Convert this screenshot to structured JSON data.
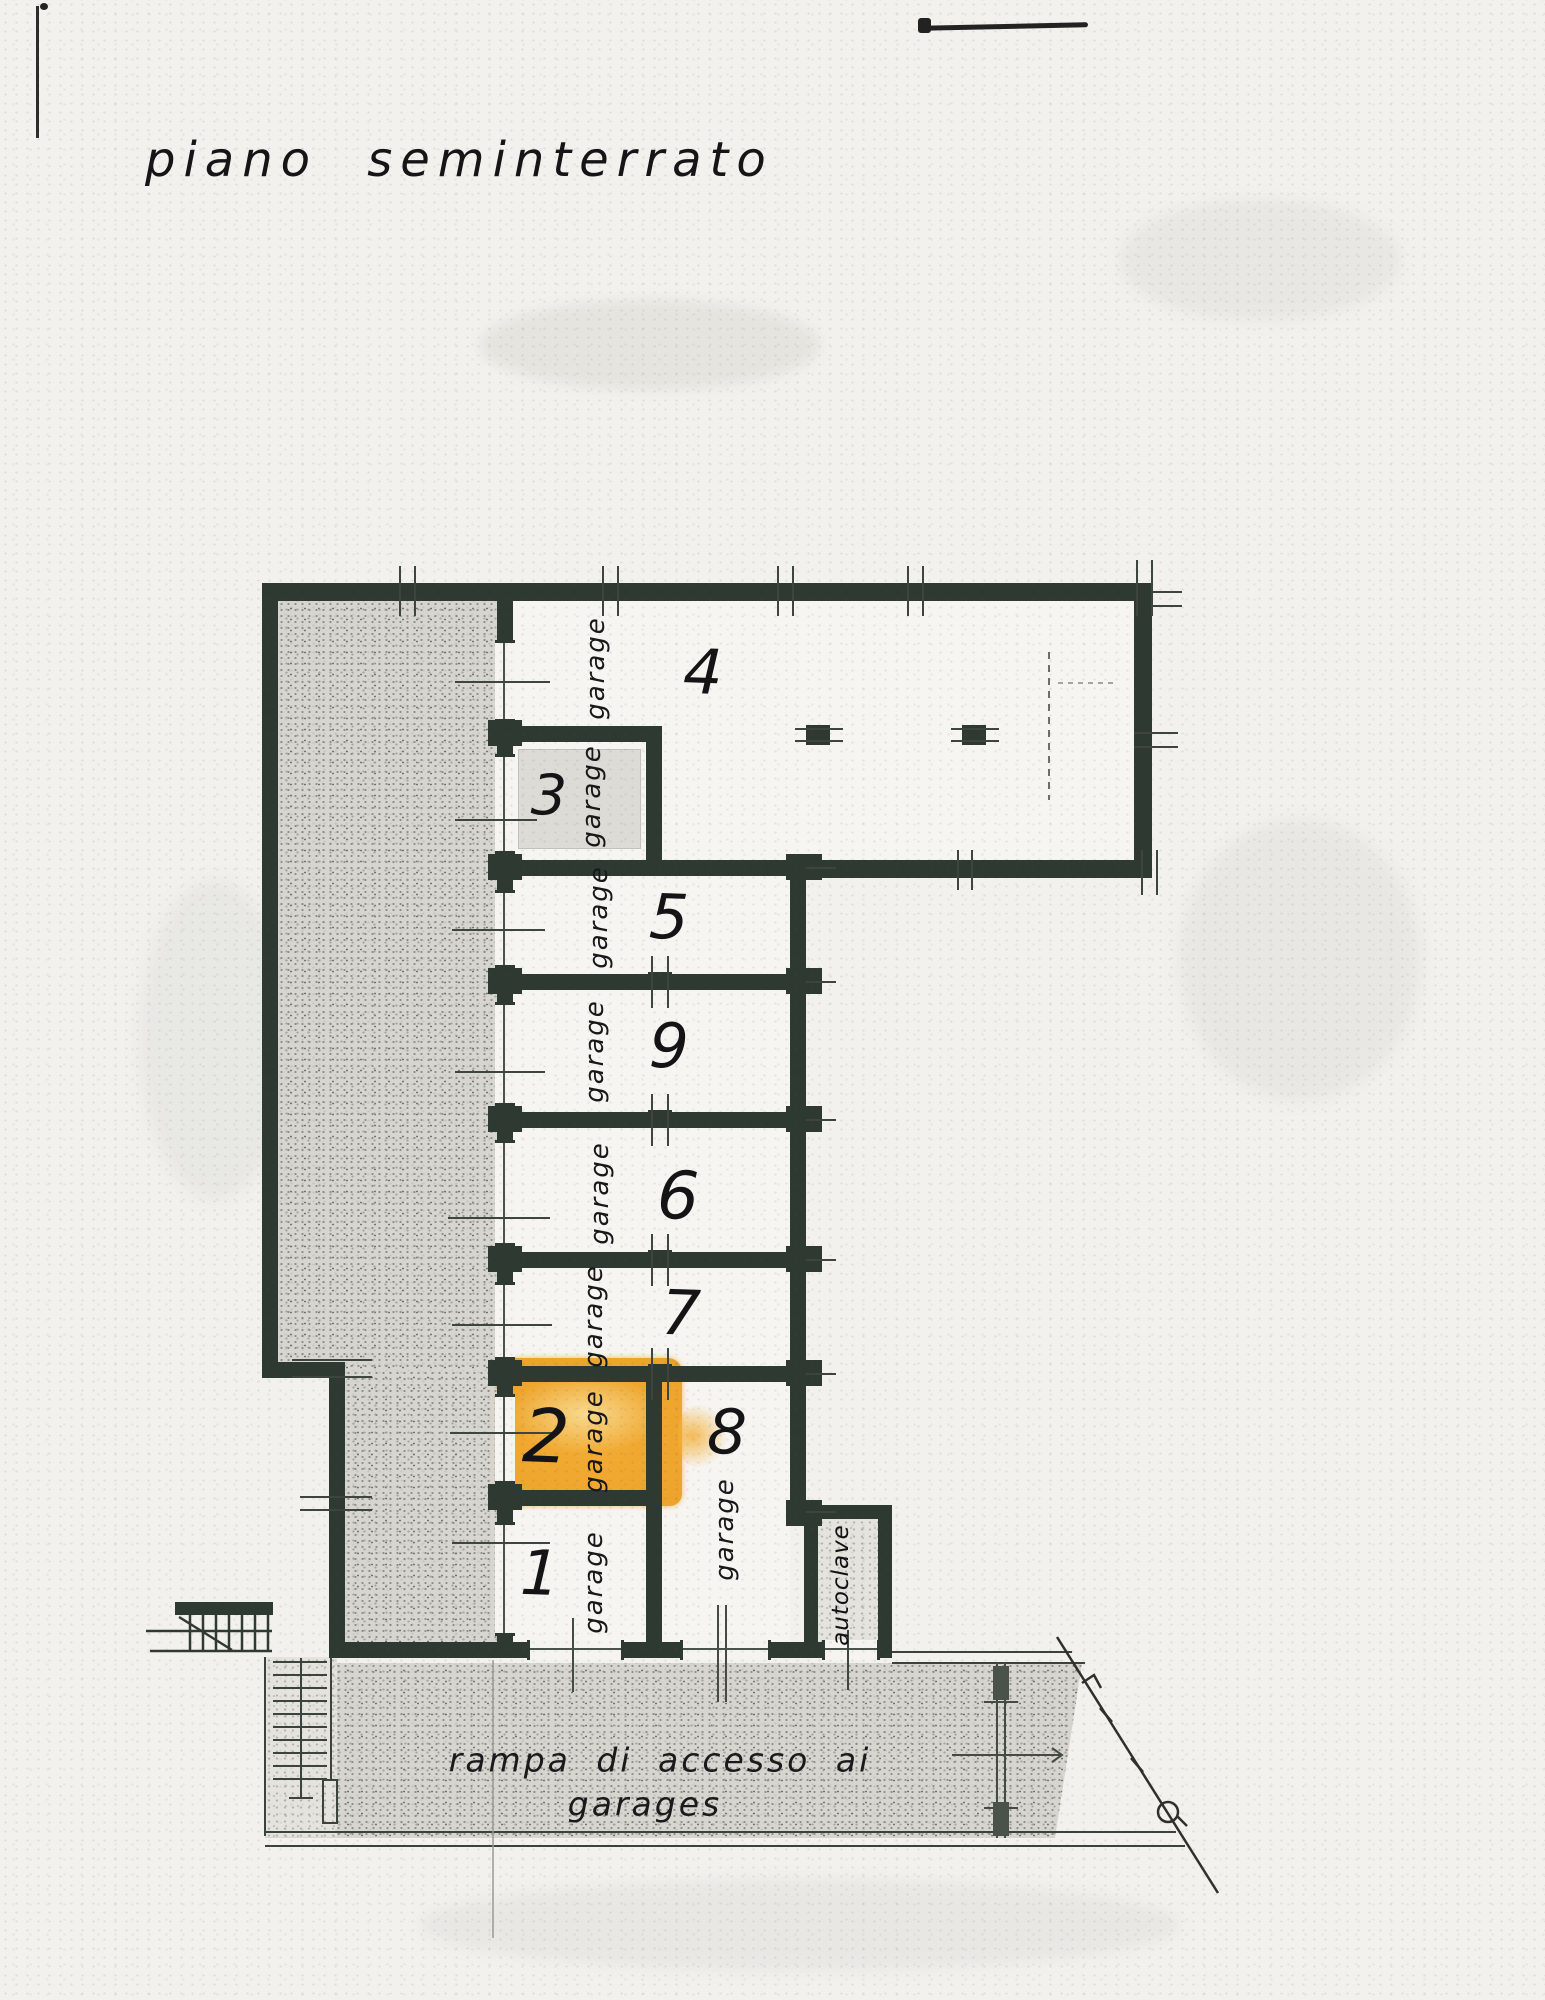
{
  "title": "piano seminterrato",
  "plan": {
    "rooms": [
      {
        "number": "4",
        "label": "garage"
      },
      {
        "number": "3",
        "label": "garage"
      },
      {
        "number": "5",
        "label": "garage"
      },
      {
        "number": "9",
        "label": "garage"
      },
      {
        "number": "6",
        "label": "garage"
      },
      {
        "number": "7",
        "label": "garage"
      },
      {
        "number": "2",
        "label": "garage",
        "highlighted": true
      },
      {
        "number": "1",
        "label": "garage"
      },
      {
        "number": "8",
        "label": "garage"
      }
    ],
    "utility_room": {
      "label": "autoclave"
    },
    "ramp": {
      "line1": "rampa di accesso ai",
      "line2": "garages"
    }
  },
  "colors": {
    "wall": "#2e3a31",
    "highlight": "#f2ab33",
    "highlight_light": "#f8d98f",
    "stipple": "#d6d5d0",
    "paper": "#f2f1ed",
    "ink": "#1c1c1c"
  }
}
